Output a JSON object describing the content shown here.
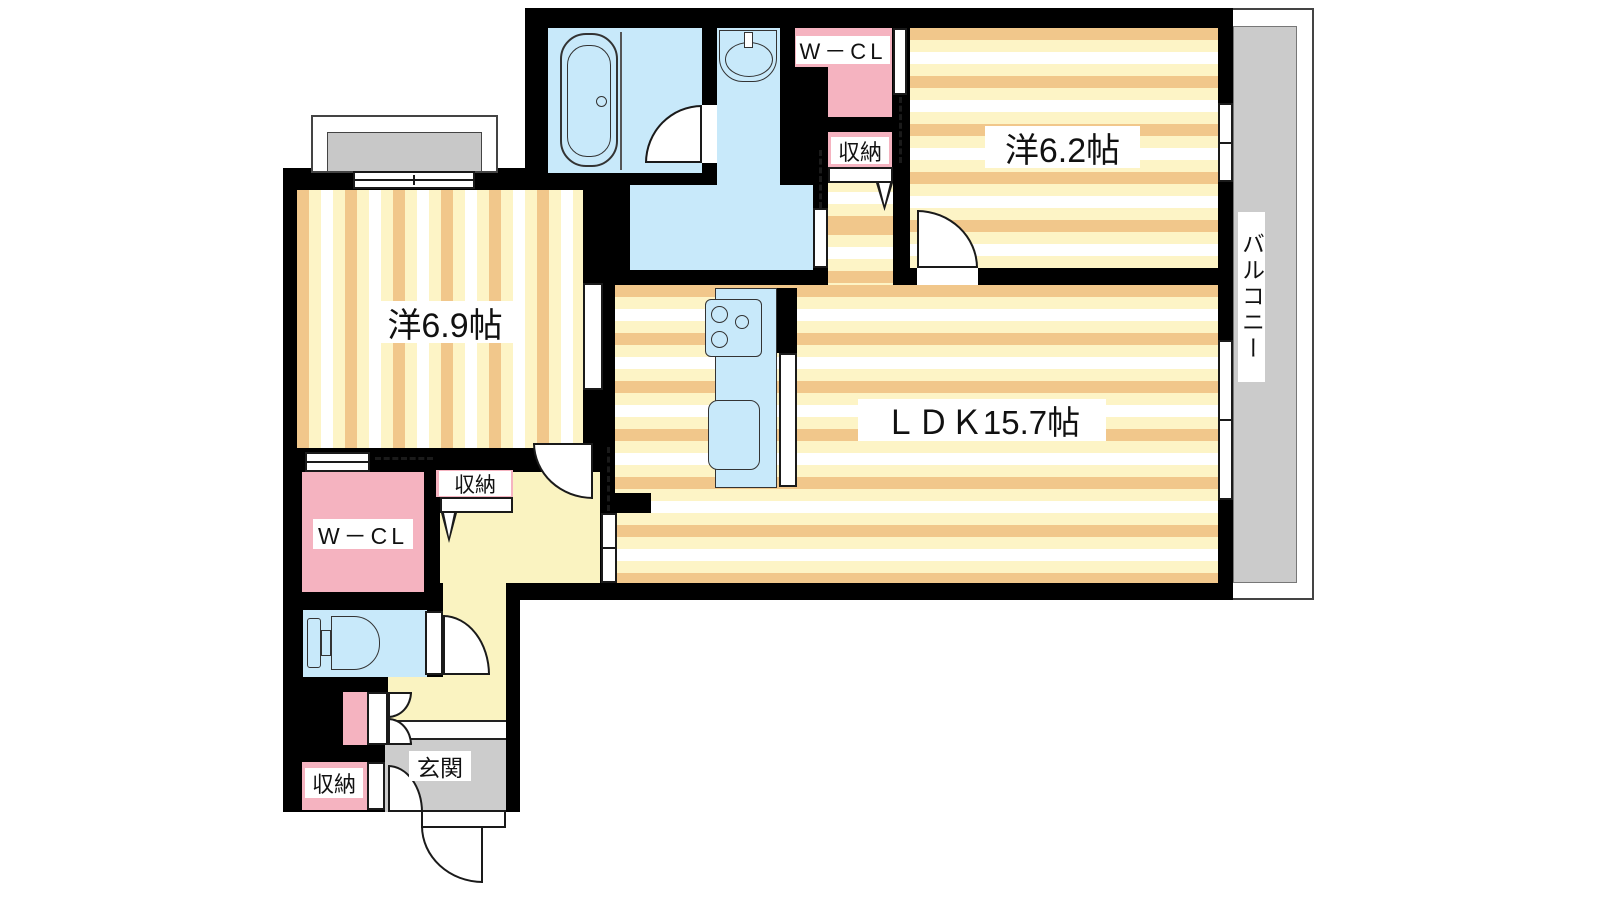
{
  "plan_title": "2LDK apartment floor plan",
  "colors": {
    "wall": "#000000",
    "stripe_tan": "#f1c78b",
    "stripe_cream": "#fdf4c6",
    "water_blue": "#c8e9fa",
    "closet_pink": "#f5b3c0",
    "hall_yellow": "#faf3c1",
    "balcony_gray": "#cbcbcb",
    "entry_gray": "#cccccc",
    "bay_gray": "#c8c8c8"
  },
  "labels": {
    "room_west_62": "洋6.2帖",
    "room_west_69": "洋6.9帖",
    "ldk": "ＬＤＫ15.7帖",
    "balcony": "バルコニー",
    "wcl_top": "W－CL",
    "wcl_bottom": "W－CL",
    "storage_top": "収納",
    "storage_mid": "収納",
    "storage_bottom": "収納",
    "entrance": "玄関"
  },
  "icons": {
    "bathtub": "double rounded-rect outline with drain circle",
    "washbasin": "oval bowl with tap stub",
    "toilet": "tank and d-shaped bowl",
    "stove": "panel with three burner circles",
    "kitchen_sink": "rounded rectangle",
    "hinged_door": "quarter-circle swing arc",
    "sliding_door": "dashed line",
    "window": "white band with mullion lines",
    "folding_door": "v-notch symbol"
  }
}
